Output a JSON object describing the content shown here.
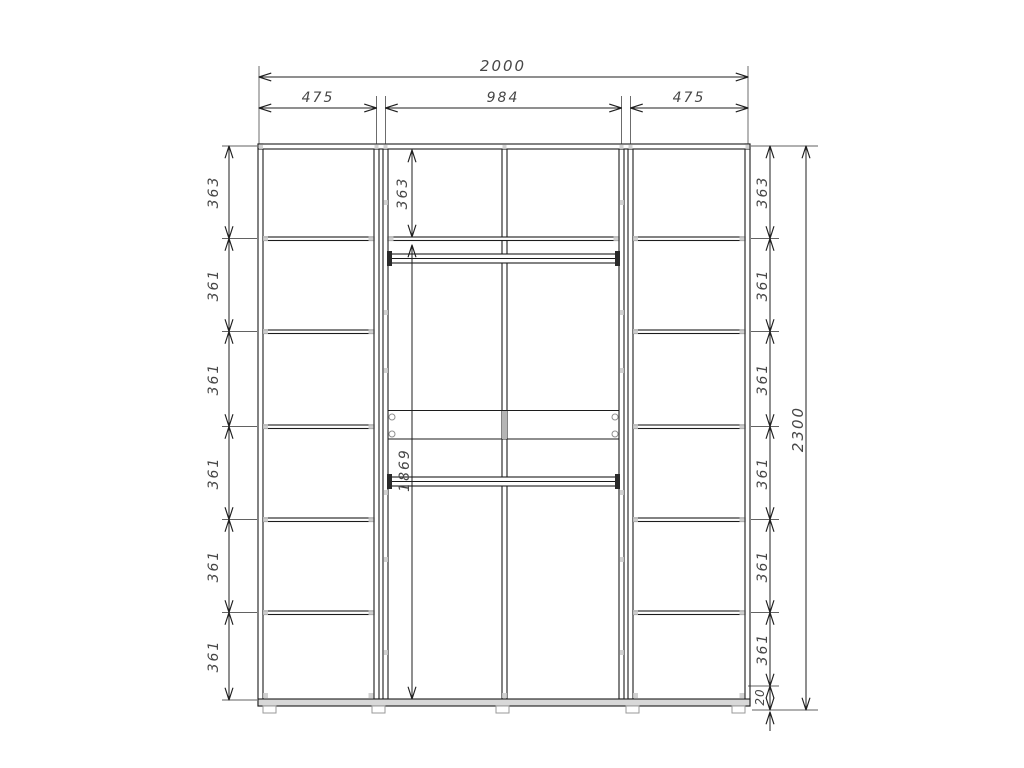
{
  "dims": {
    "width_total": "2000",
    "width_sections": [
      "475",
      "984",
      "475"
    ],
    "height_total": "2300",
    "left_chain": [
      "363",
      "361",
      "361",
      "361",
      "361",
      "361"
    ],
    "right_chain": [
      "363",
      "361",
      "361",
      "361",
      "361",
      "361"
    ],
    "middle_top_section": "363",
    "middle_hanging_section": "1869",
    "bottom_clearance": "20"
  },
  "colors": {
    "line": "#1f1f1f",
    "dim_text": "#474747",
    "hardware_mark": "#c9c9c9",
    "bottom_panel": "#d8d8d8",
    "shaded_divider": "#b5b5b5",
    "background": "#ffffff"
  }
}
